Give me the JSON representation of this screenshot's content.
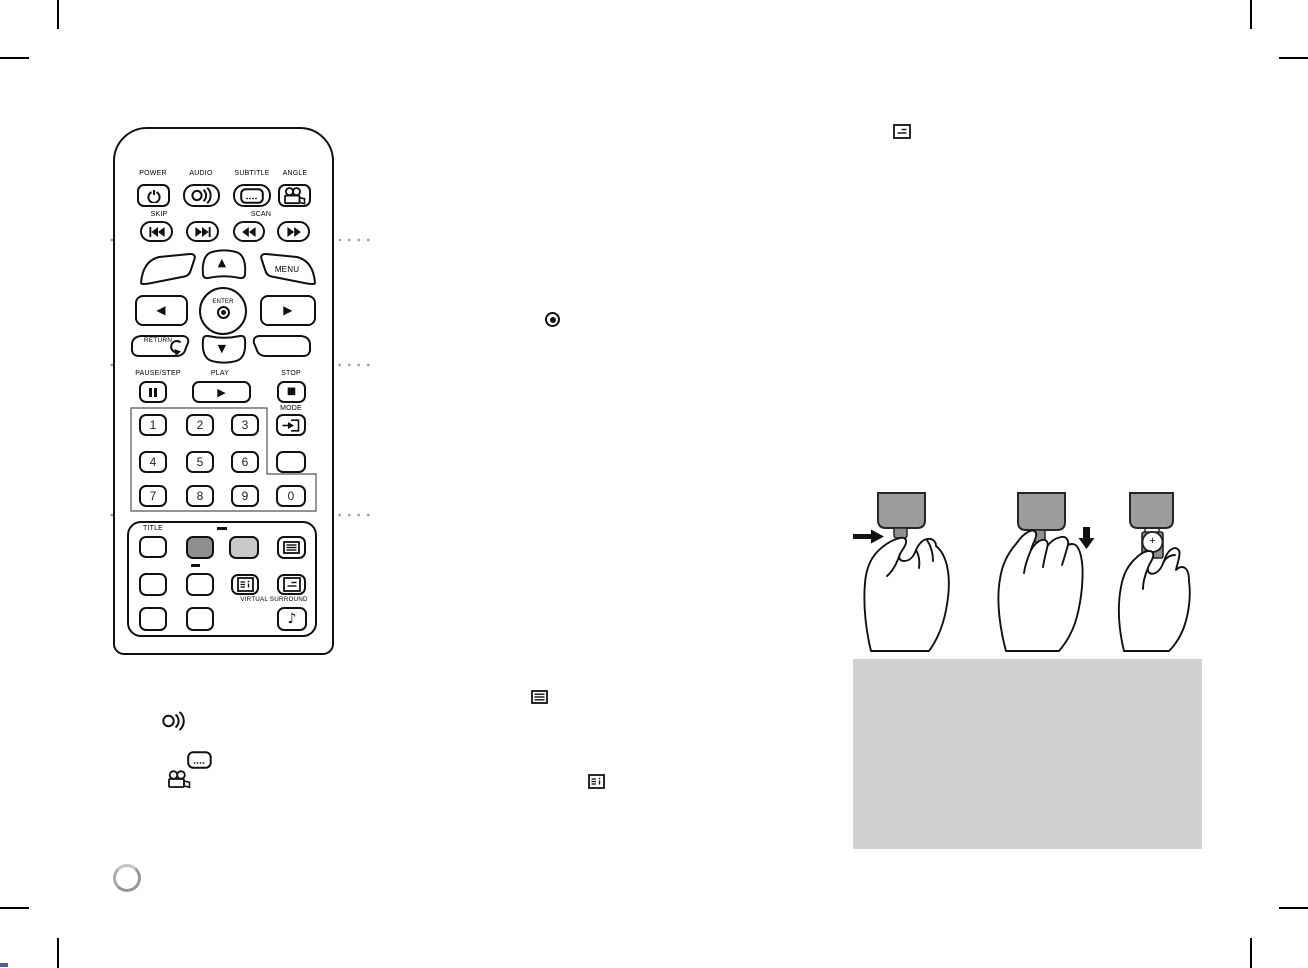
{
  "colors": {
    "line": "#111111",
    "dark_button": "#8f8f8f",
    "light_button": "#c9c9c9",
    "note_box_bg": "#d1d1d1",
    "remote_gray": "#9c9c9c",
    "dot_gray": "#9b9b9b"
  },
  "remote": {
    "top": {
      "power_label": "POWER",
      "audio_label": "AUDIO",
      "subtitle_label": "SUBTITLE",
      "angle_label": "ANGLE",
      "skip_label": "SKIP",
      "scan_label": "SCAN"
    },
    "nav": {
      "menu_label": "MENU",
      "enter_label": "ENTER",
      "return_label": "RETURN",
      "up_glyph": "▲",
      "down_glyph": "▼",
      "left_glyph": "◀",
      "right_glyph": "▶"
    },
    "playback": {
      "pause_label": "PAUSE/STEP",
      "play_label": "PLAY",
      "stop_label": "STOP",
      "mode_label": "MODE",
      "play_glyph": "▶",
      "stop_glyph": "■"
    },
    "keypad": {
      "digits": [
        "1",
        "2",
        "3",
        "4",
        "5",
        "6",
        "7",
        "8",
        "9",
        "0"
      ]
    },
    "bottom": {
      "title_label": "TITLE",
      "virtual_surround_label": "VIRTUAL SURROUND",
      "music_note_glyph": "♪"
    }
  },
  "battery_illustration": {
    "plus_sign": "+"
  },
  "icons": {
    "standalone": [
      "osd-box-icon",
      "enter-target-icon",
      "menu-box-icon",
      "audio-waves-icon",
      "subtitle-box-icon",
      "camera-angle-icon",
      "display-info-icon"
    ]
  }
}
